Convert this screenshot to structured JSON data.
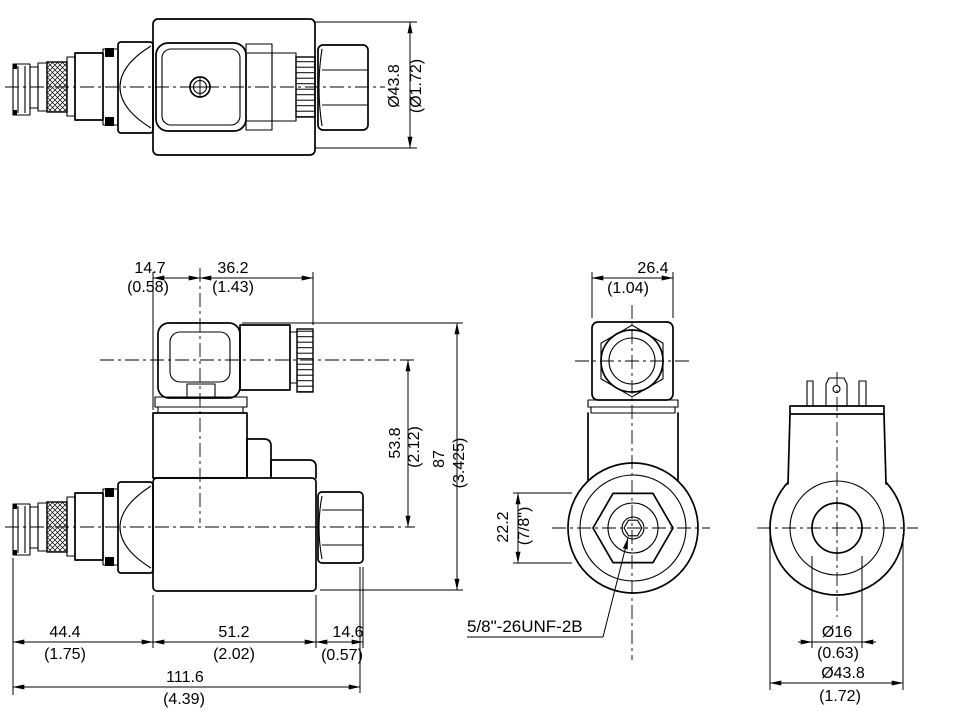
{
  "dims": {
    "top_view": {
      "coil_dia": "Ø43.8",
      "coil_dia_in": "(Ø1.72)"
    },
    "front_view": {
      "conn_offset": "14.7",
      "conn_offset_in": "(0.58)",
      "conn_width": "36.2",
      "conn_width_in": "(1.43)",
      "center_height": "53.8",
      "center_height_in": "(2.12)",
      "total_height": "87",
      "total_height_in": "(3.425)",
      "cartridge_len": "44.4",
      "cartridge_len_in": "(1.75)",
      "body_len": "51.2",
      "body_len_in": "(2.02)",
      "nut_len": "14.6",
      "nut_len_in": "(0.57)",
      "total_len": "111.6",
      "total_len_in": "(4.39)"
    },
    "side_view": {
      "top_width": "26.4",
      "top_width_in": "(1.04)",
      "hex_flats": "22.2",
      "hex_flats_in": "(7/8\")",
      "thread_callout": "5/8\"-26UNF-2B"
    },
    "rear_view": {
      "hole_dia": "Ø16",
      "hole_dia_in": "(0.63)",
      "coil_dia": "Ø43.8",
      "coil_dia_in": "(1.72)"
    }
  }
}
